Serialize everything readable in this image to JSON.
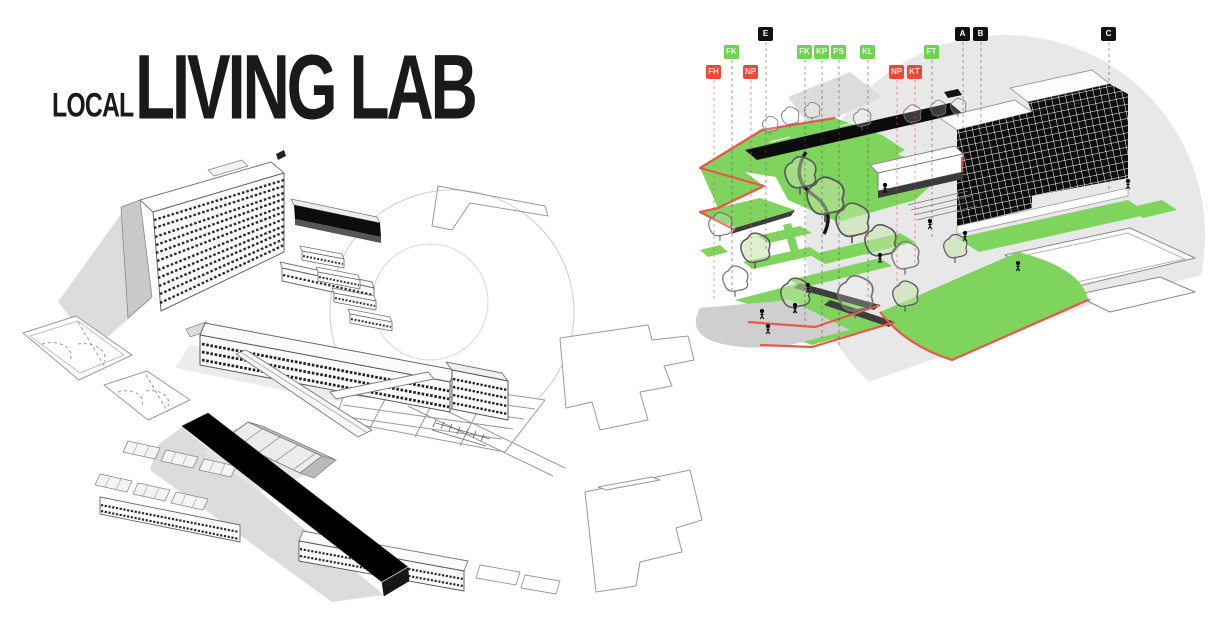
{
  "title": {
    "prefix": "LOCAL",
    "main": "LIVING LAB"
  },
  "markers": [
    {
      "label": "FH",
      "color": "red"
    },
    {
      "label": "FK",
      "color": "green"
    },
    {
      "label": "NP",
      "color": "red"
    },
    {
      "label": "E",
      "color": "black"
    },
    {
      "label": "FK",
      "color": "green"
    },
    {
      "label": "KP",
      "color": "green"
    },
    {
      "label": "PS",
      "color": "green"
    },
    {
      "label": "KL",
      "color": "green"
    },
    {
      "label": "NP",
      "color": "red"
    },
    {
      "label": "KT",
      "color": "red"
    },
    {
      "label": "FT",
      "color": "green"
    },
    {
      "label": "A",
      "color": "black"
    },
    {
      "label": "B",
      "color": "black"
    },
    {
      "label": "C",
      "color": "black"
    }
  ],
  "colors": {
    "marker_red": "#e8493a",
    "marker_green": "#6ed351",
    "marker_black": "#111111",
    "lawn_green": "#7ed45c",
    "path_red": "#e8584a",
    "building_black": "#0d0d0d",
    "shadow_gray": "#d9d9d9",
    "background_gray": "#e8e8e8"
  }
}
